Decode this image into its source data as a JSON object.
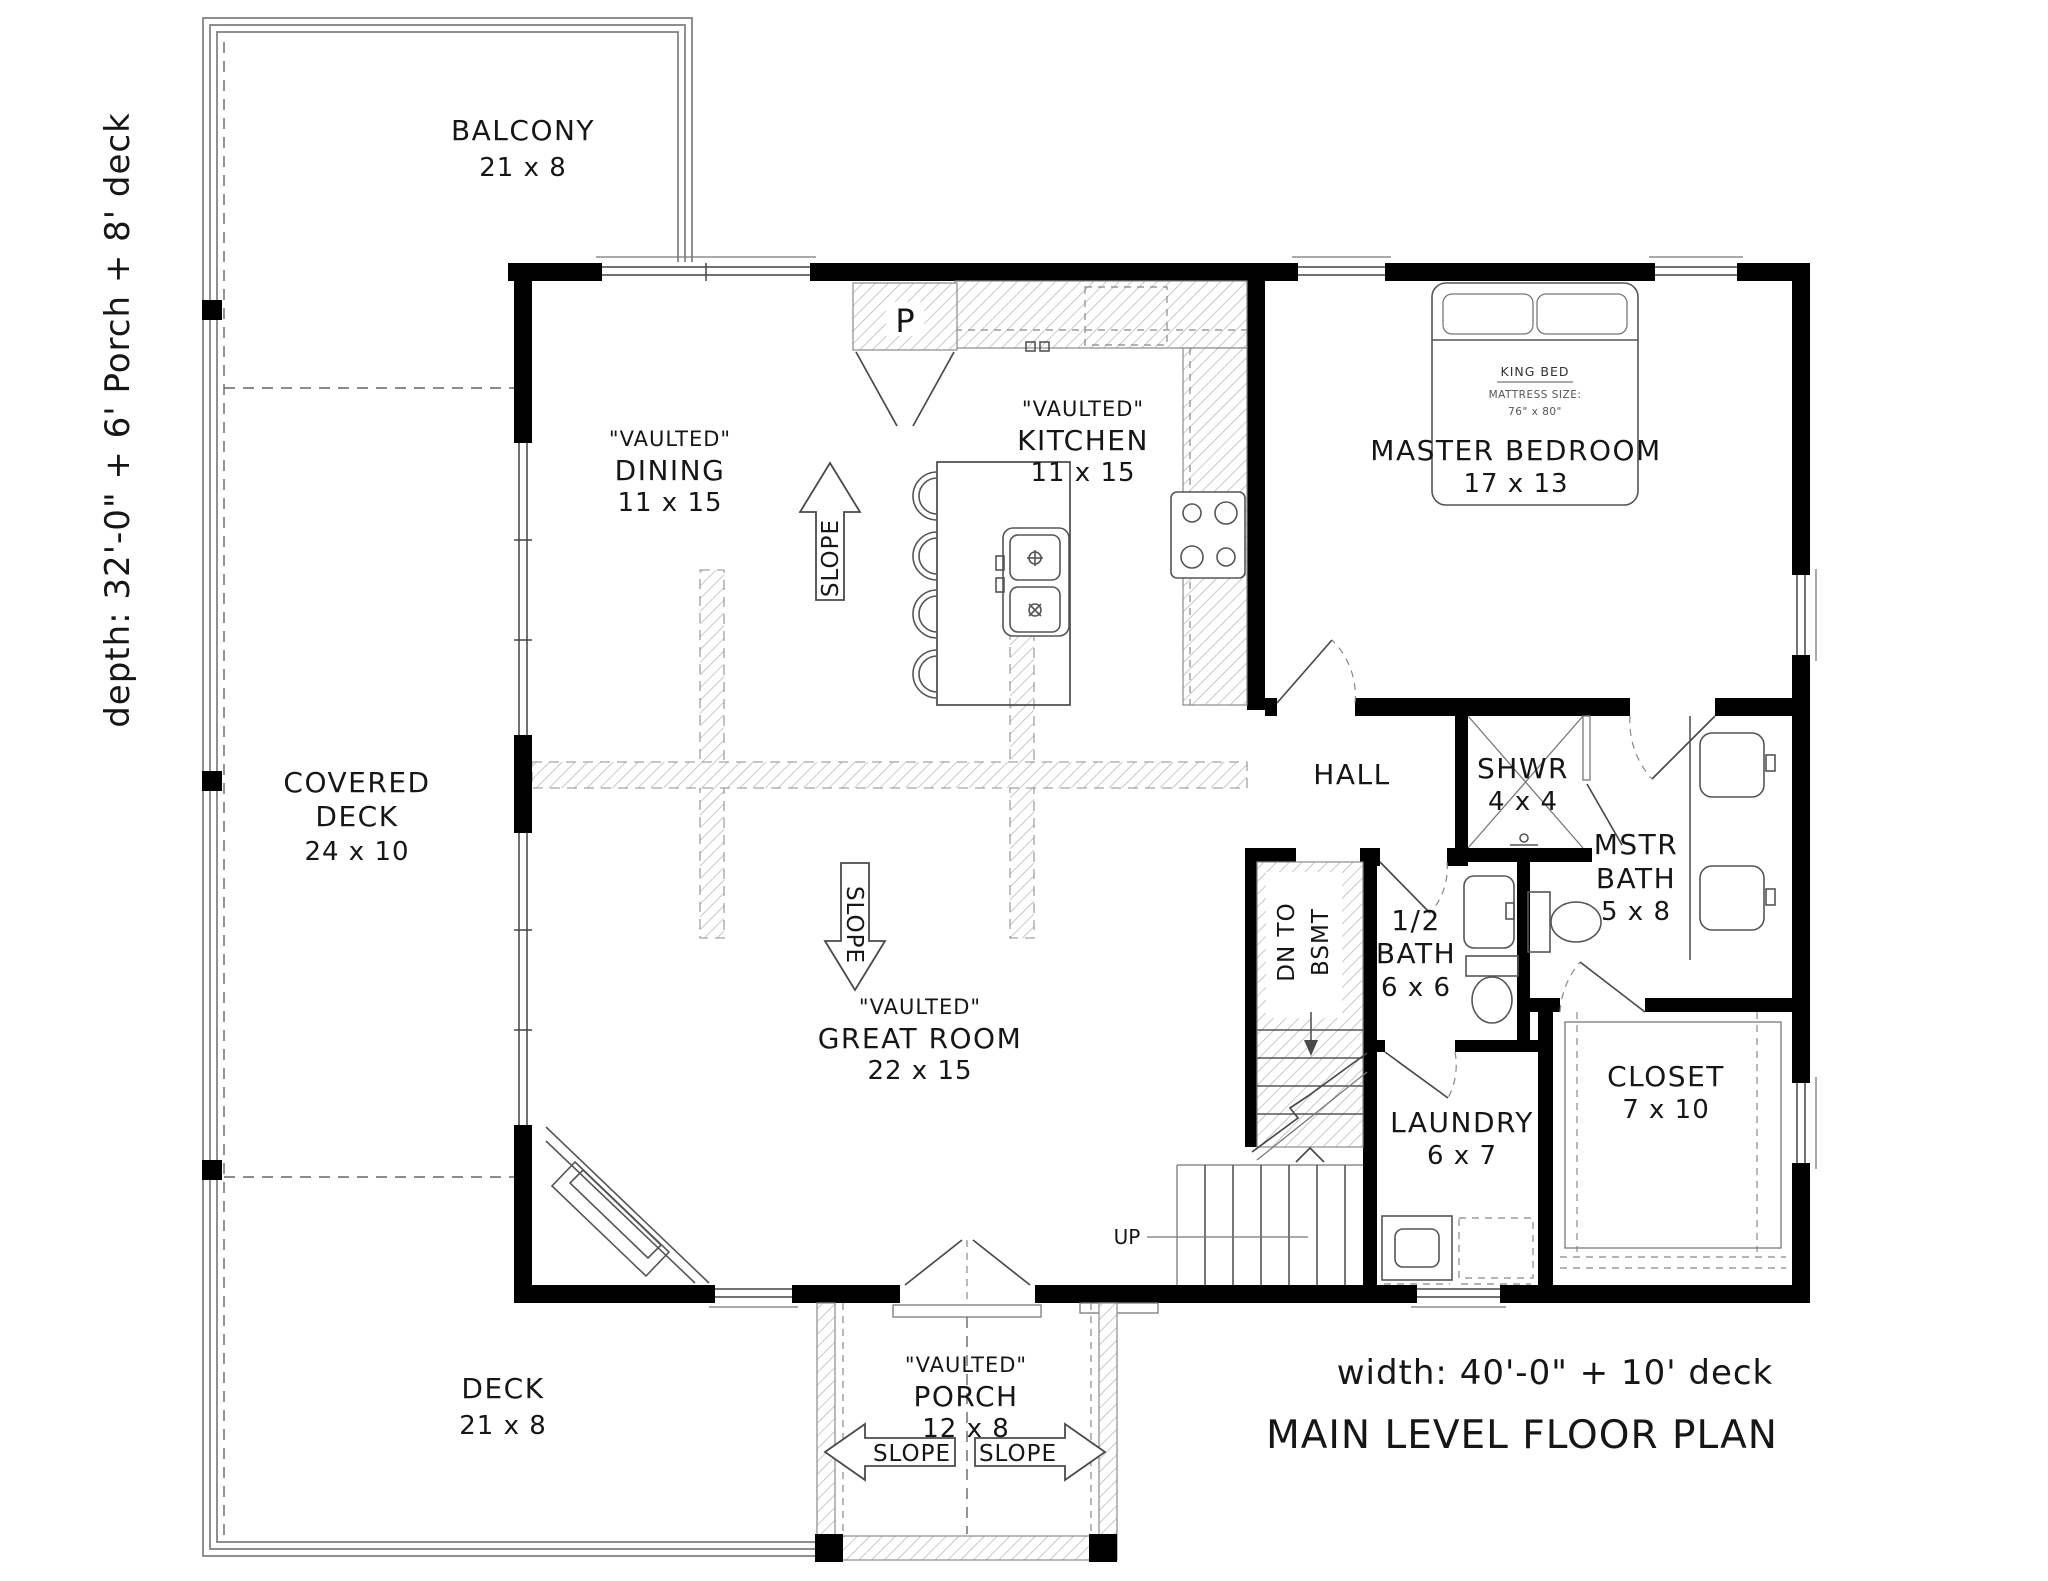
{
  "plan": {
    "depth_note": "depth: 32'-0\" + 6' Porch + 8' deck",
    "width_note": "width: 40'-0\" + 10' deck",
    "title": "MAIN LEVEL FLOOR PLAN"
  },
  "labels": {
    "vaulted": "\"VAULTED\"",
    "slope": "SLOPE",
    "up": "UP",
    "dn_line1": "DN TO",
    "dn_line2": "BSMT",
    "pantry": "P"
  },
  "outdoor": {
    "balcony": {
      "name": "BALCONY",
      "dims": "21 x 8"
    },
    "covered_deck": {
      "line1": "COVERED",
      "line2": "DECK",
      "dims": "24 x 10"
    },
    "deck": {
      "name": "DECK",
      "dims": "21 x 8"
    },
    "porch": {
      "name": "PORCH",
      "dims": "12 x 8"
    }
  },
  "rooms": {
    "dining": {
      "name": "DINING",
      "dims": "11 x 15"
    },
    "kitchen": {
      "name": "KITCHEN",
      "dims": "11 x 15"
    },
    "great_room": {
      "name": "GREAT ROOM",
      "dims": "22 x 15"
    },
    "master_bedroom": {
      "name": "MASTER BEDROOM",
      "dims": "17 x 13"
    },
    "hall": {
      "name": "HALL"
    },
    "shower": {
      "name": "SHWR",
      "dims": "4 x 4"
    },
    "master_bath": {
      "line1": "MSTR",
      "line2": "BATH",
      "dims": "5 x 8"
    },
    "half_bath": {
      "line1": "1/2",
      "line2": "BATH",
      "dims": "6 x 6"
    },
    "laundry": {
      "name": "LAUNDRY",
      "dims": "6 x 7"
    },
    "closet": {
      "name": "CLOSET",
      "dims": "7 x 10"
    }
  },
  "fixtures": {
    "king_bed": {
      "line1": "KING BED",
      "line2": "MATTRESS SIZE:",
      "line3": "76\" x 80\""
    }
  },
  "colors": {
    "wall": "#000000",
    "line": "#4a4a4a",
    "deck_line": "#7e7e7e",
    "hatch": "#adadad"
  }
}
